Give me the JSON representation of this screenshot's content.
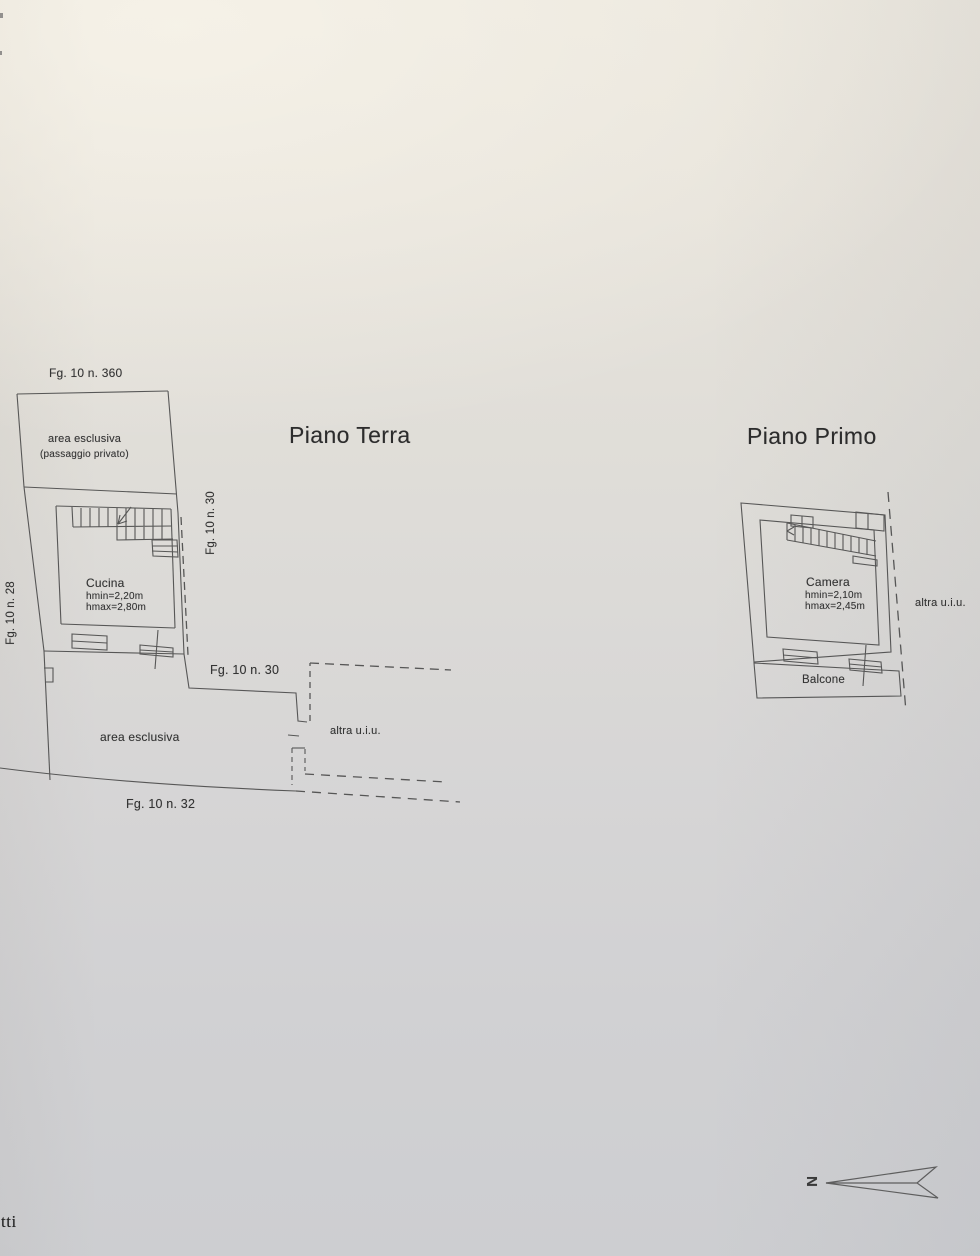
{
  "colors": {
    "paper_top": "#eae6dd",
    "paper_bottom": "#cdced1",
    "ink": "#4c4c4c",
    "text": "#343434"
  },
  "ground_floor": {
    "title": "Piano Terra",
    "labels": {
      "parcel_top": "Fg. 10 n. 360",
      "exclusive_area_line1": "area esclusiva",
      "exclusive_area_line2": "(passaggio privato)",
      "boundary_left_vertical": "Fg. 10 n. 28",
      "boundary_right_vertical": "Fg. 10 n. 30",
      "boundary_mid": "Fg. 10 n. 30",
      "exclusive_area_bottom": "area esclusiva",
      "adjacent_unit": "altra u.i.u.",
      "boundary_bottom": "Fg. 10 n. 32"
    },
    "room": {
      "name": "Cucina",
      "height_min": "hmin=2,20m",
      "height_max": "hmax=2,80m"
    }
  },
  "first_floor": {
    "title": "Piano Primo",
    "room": {
      "name": "Camera",
      "height_min": "hmin=2,10m",
      "height_max": "hmax=2,45m"
    },
    "labels": {
      "balcony": "Balcone",
      "adjacent_unit": "altra u.i.u."
    }
  },
  "compass": {
    "letter": "N"
  },
  "margin_fragment": "tti"
}
